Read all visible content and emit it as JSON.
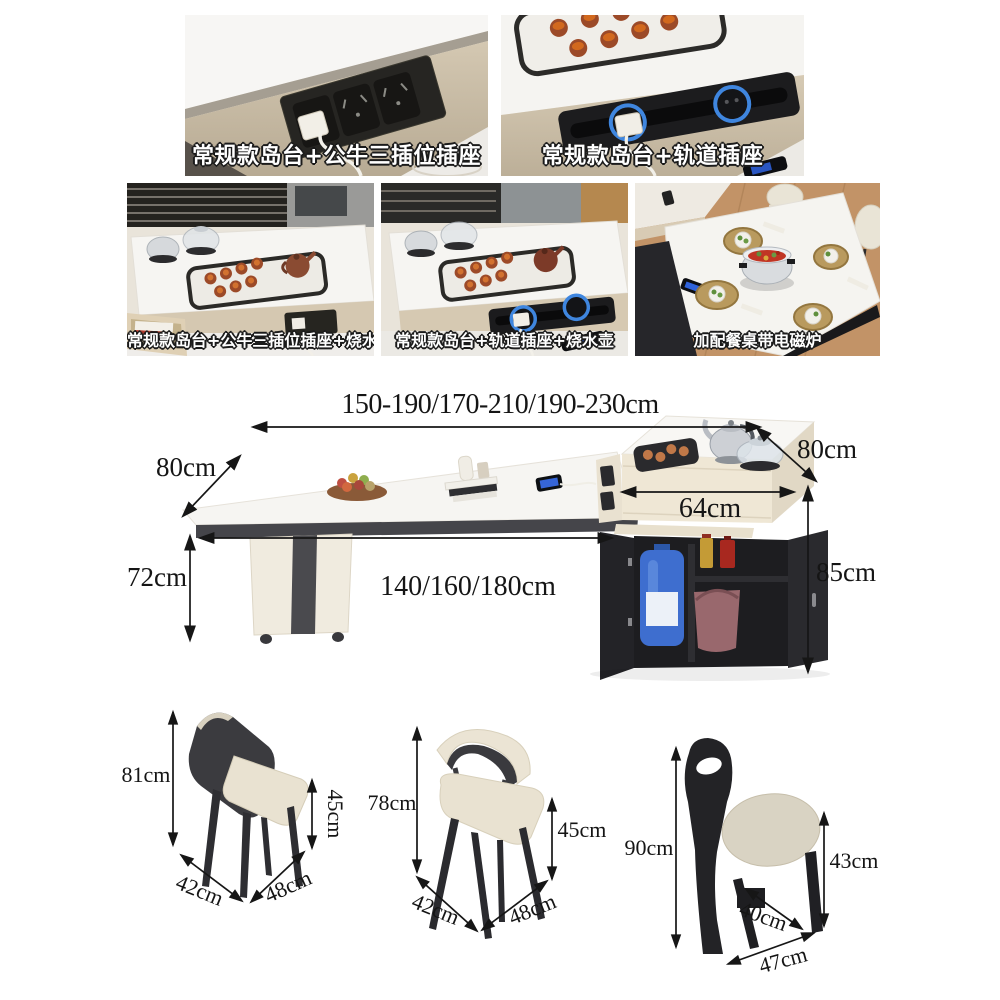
{
  "feature_cards": {
    "row1": [
      {
        "label": "常规款岛台+公牛三插位插座"
      },
      {
        "label": "常规款岛台+轨道插座"
      }
    ],
    "row2": [
      {
        "label": "常规款岛台+公牛三插位插座+烧水壶"
      },
      {
        "label": "常规款岛台+轨道插座+烧水壶"
      },
      {
        "label": "加配餐桌带电磁炉"
      }
    ]
  },
  "table_diagram": {
    "length_options": "150-190/170-210/190-230cm",
    "tabletop_depth": "80cm",
    "island_depth": "80cm",
    "tabletop_height": "72cm",
    "base_length_options": "140/160/180cm",
    "island_width": "64cm",
    "island_height": "85cm"
  },
  "chairs": [
    {
      "height": "81cm",
      "seat_height": "45cm",
      "seat_depth": "42cm",
      "seat_width": "48cm"
    },
    {
      "height": "78cm",
      "seat_height": "45cm",
      "seat_depth": "42cm",
      "seat_width": "48cm"
    },
    {
      "height": "90cm",
      "seat_height": "43cm",
      "seat_depth": "40cm",
      "seat_width": "47cm"
    }
  ],
  "colors": {
    "beige_panel": "#cdc1ab",
    "tabletop_white": "#f6f5f2",
    "socket_black": "#242322",
    "track_ring_blue": "#3f86df",
    "chair_dark": "#3b3b3f",
    "seat_cream": "#e9e2d1",
    "wood_floor": "#c29367",
    "dimension_text": "#151515"
  }
}
